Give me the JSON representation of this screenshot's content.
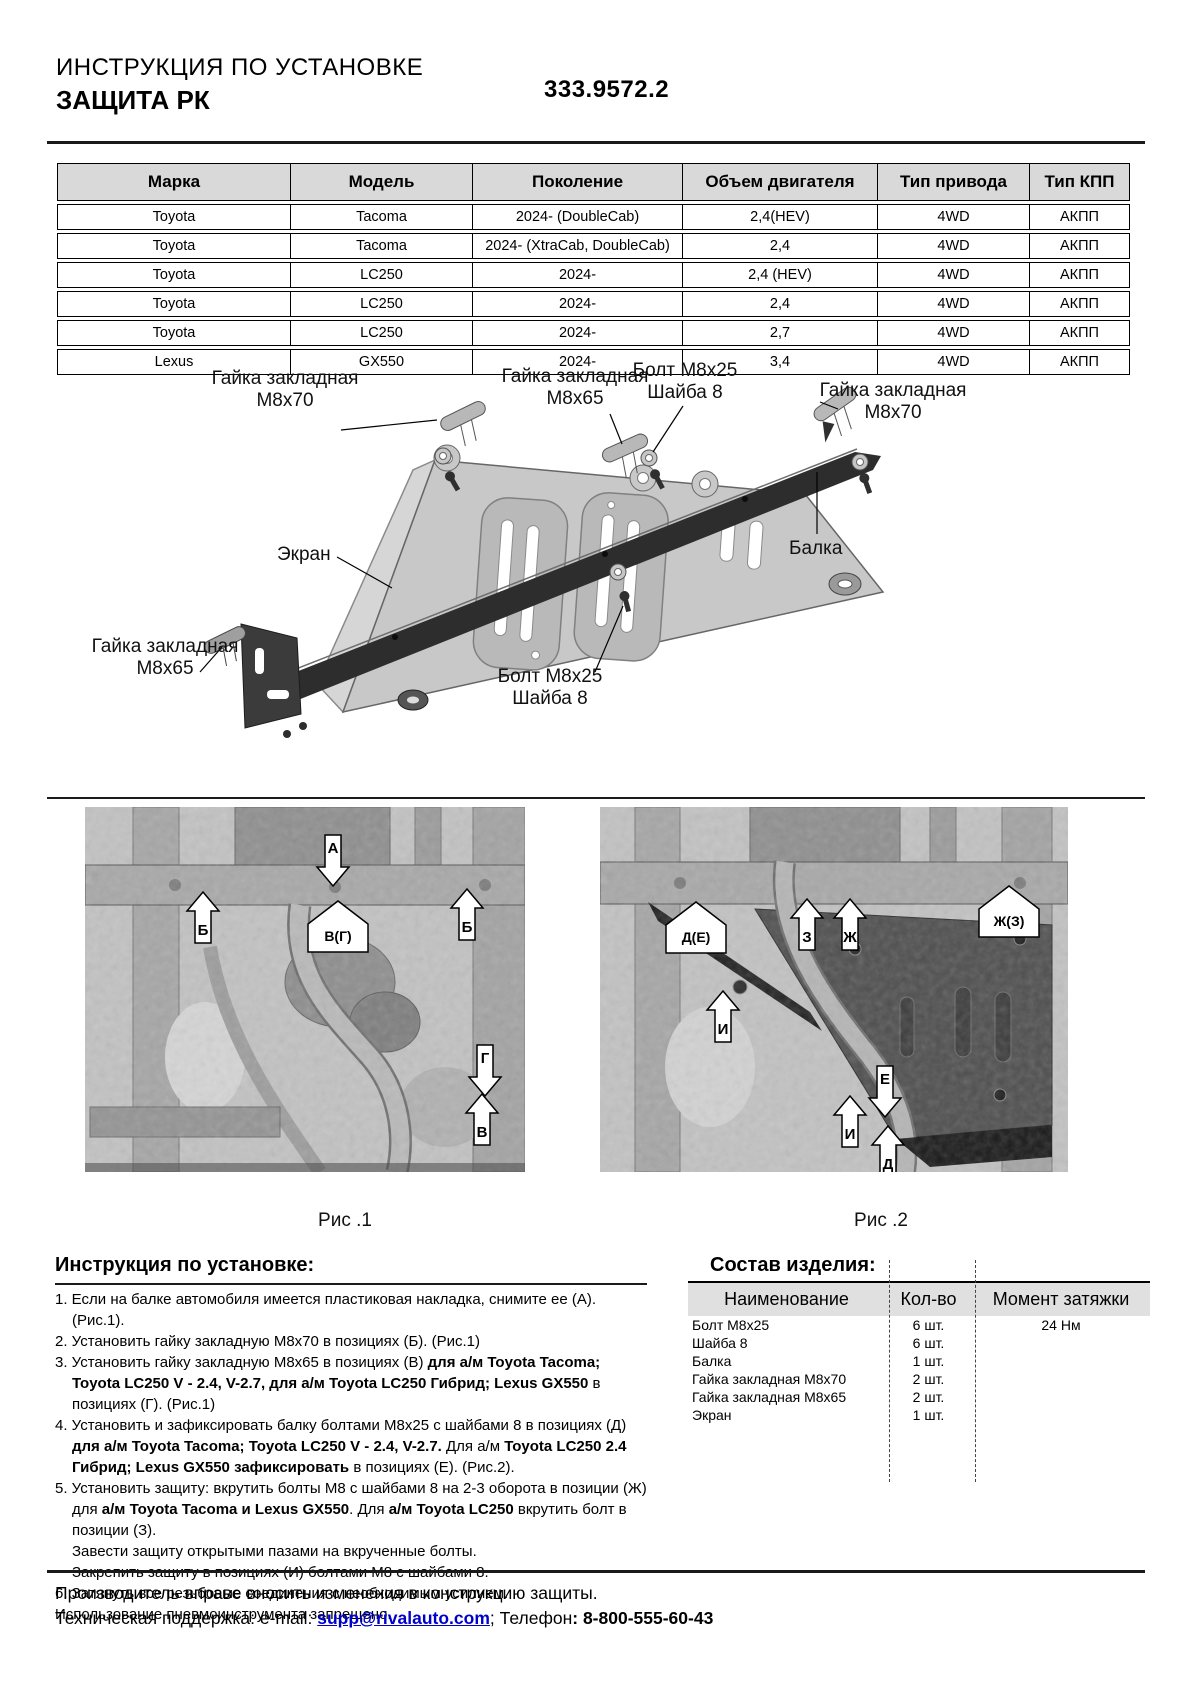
{
  "header": {
    "title_line1": "ИНСТРУКЦИЯ ПО УСТАНОВКЕ",
    "title_line2": "ЗАЩИТА РК",
    "part_number": "333.9572.2"
  },
  "fitment_table": {
    "headers": [
      "Марка",
      "Модель",
      "Поколение",
      "Объем двигателя",
      "Тип привода",
      "Тип КПП"
    ],
    "rows": [
      [
        "Toyota",
        "Tacoma",
        "2024- (DoubleCab)",
        "2,4(HEV)",
        "4WD",
        "АКПП"
      ],
      [
        "Toyota",
        "Tacoma",
        "2024- (XtraCab, DoubleCab)",
        "2,4",
        "4WD",
        "АКПП"
      ],
      [
        "Toyota",
        "LC250",
        "2024-",
        "2,4 (HEV)",
        "4WD",
        "АКПП"
      ],
      [
        "Toyota",
        "LC250",
        "2024-",
        "2,4",
        "4WD",
        "АКПП"
      ],
      [
        "Toyota",
        "LC250",
        "2024-",
        "2,7",
        "4WD",
        "АКПП"
      ],
      [
        "Lexus",
        "GX550",
        "2024-",
        "3,4",
        "4WD",
        "АКПП"
      ]
    ]
  },
  "diagram": {
    "labels": [
      {
        "line1": "Гайка закладная",
        "line2": "М8х70"
      },
      {
        "line1": "Гайка закладная",
        "line2": "М8х65"
      },
      {
        "line1": "Болт М8х25",
        "line2": "Шайба 8"
      },
      {
        "line1": "Гайка закладная",
        "line2": "М8х70"
      },
      {
        "line1": "Экран"
      },
      {
        "line1": "Балка"
      },
      {
        "line1": "Гайка закладная",
        "line2": "М8х65"
      },
      {
        "line1": "Болт М8х25",
        "line2": "Шайба 8"
      }
    ]
  },
  "figures": {
    "fig1": {
      "caption": "Рис .1",
      "callouts": [
        "А",
        "Б",
        "В(Г)",
        "Б",
        "Г",
        "В"
      ]
    },
    "fig2": {
      "caption": "Рис .2",
      "callouts": [
        "Д(Е)",
        "З",
        "Ж",
        "Ж(З)",
        "И",
        "Е",
        "И",
        "Д"
      ]
    }
  },
  "instructions": {
    "title": "Инструкция по установке:",
    "items": [
      {
        "style": "num",
        "seg": [
          {
            "t": "1. Если на балке автомобиля имеется пластиковая накладка, снимите ее (А). (Рис.1)."
          }
        ]
      },
      {
        "style": "num",
        "seg": [
          {
            "t": "2. Установить гайку закладную М8х70 в позициях (Б). (Рис.1)"
          }
        ]
      },
      {
        "style": "num",
        "seg": [
          {
            "t": "3. Установить гайку закладную М8х65 в позициях (В) "
          },
          {
            "t": "для а/м Toyota Tacoma; Toyota LC250 V - 2.4, V-2.7, для а/м Toyota LC250 Гибрид; Lexus GX550",
            "b": true
          },
          {
            "t": " в позициях (Г).  (Рис.1)"
          }
        ]
      },
      {
        "style": "num",
        "seg": [
          {
            "t": "4. Установить и зафиксировать балку болтами М8х25 с шайбами 8 в позициях (Д) "
          },
          {
            "t": "для а/м Toyota Tacoma; Toyota LC250 V - 2.4, V-2.7.",
            "b": true
          },
          {
            "t": "  Для а/м "
          },
          {
            "t": "Toyota LC250 2.4 Гибрид; Lexus GX550 зафиксировать",
            "b": true
          },
          {
            "t": " в позициях (Е). (Рис.2)."
          }
        ]
      },
      {
        "style": "num",
        "seg": [
          {
            "t": "5. Установить защиту: вкрутить болты М8 с шайбами 8 на 2-3 оборота в позиции (Ж) для "
          },
          {
            "t": "а/м Toyota Tacoma и Lexus GX550",
            "b": true
          },
          {
            "t": ". Для "
          },
          {
            "t": "а/м Toyota LC250",
            "b": true
          },
          {
            "t": " вкрутить болт в позиции (З)."
          }
        ]
      },
      {
        "style": "cont",
        "seg": [
          {
            "t": "Завести защиту открытыми пазами на вкрученные болты."
          }
        ]
      },
      {
        "style": "cont",
        "seg": [
          {
            "t": "Закрепить защиту в позициях (И) болтами М8 с шайбами 8."
          }
        ]
      },
      {
        "style": "num",
        "seg": [
          {
            "t": "6. Затянуть все резьбовые соединения с необходимым усилием."
          }
        ]
      },
      {
        "style": "flush",
        "seg": [
          {
            "t": "Использование пневмоинструмента запрещено."
          }
        ]
      }
    ]
  },
  "parts": {
    "title": "Состав изделия:",
    "headers": [
      "Наименование",
      "Кол-во",
      "Момент затяжки"
    ],
    "rows": [
      {
        "name": "Болт М8х25",
        "qty": "6 шт.",
        "torque": "24 Нм"
      },
      {
        "name": "Шайба 8",
        "qty": "6 шт.",
        "torque": ""
      },
      {
        "name": "Балка",
        "qty": "1 шт.",
        "torque": ""
      },
      {
        "name": "Гайка закладная М8х70",
        "qty": "2 шт.",
        "torque": ""
      },
      {
        "name": "Гайка закладная М8х65",
        "qty": "2 шт.",
        "torque": ""
      },
      {
        "name": "Экран",
        "qty": "1 шт.",
        "torque": ""
      }
    ]
  },
  "footer": {
    "line1": "Производитель вправе вносить изменения в конструкцию защиты.",
    "support_prefix": "Техническая поддержка:  e-mail: ",
    "email": "supp@rivalauto.com",
    "after_email": ";",
    "phone_label": " Телефон",
    "phone": ": 8-800-555-60-43"
  }
}
